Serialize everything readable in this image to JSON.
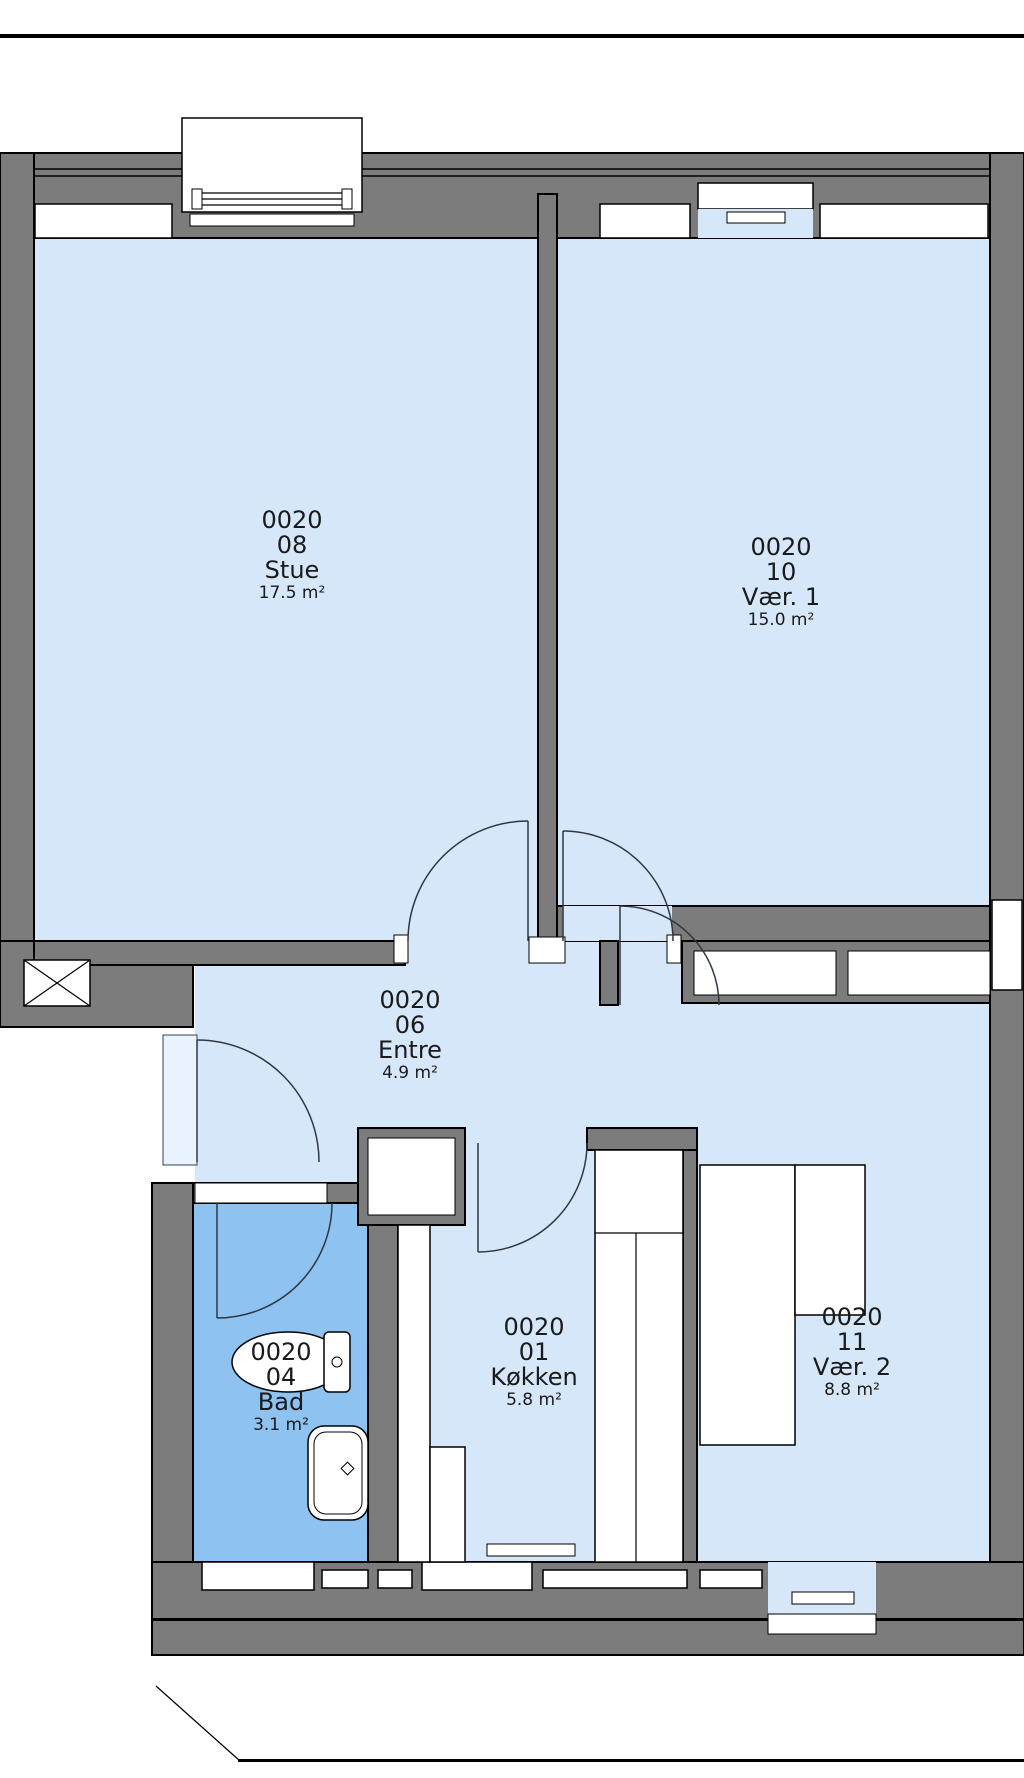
{
  "title": "Apartment floor plan 0020",
  "colors": {
    "wall": "#7c7c7c",
    "room": "#d6e7fa",
    "bathroom": "#8ec2f0",
    "threshold": "#e9f3fd",
    "arc": "#2f3742",
    "label": "#1a1a1a"
  },
  "rooms": [
    {
      "id": "stue",
      "code": "0020",
      "number": "08",
      "name": "Stue",
      "area": "17.5 m²"
    },
    {
      "id": "vaer1",
      "code": "0020",
      "number": "10",
      "name": "Vær. 1",
      "area": "15.0 m²"
    },
    {
      "id": "entre",
      "code": "0020",
      "number": "06",
      "name": "Entre",
      "area": "4.9 m²"
    },
    {
      "id": "bad",
      "code": "0020",
      "number": "04",
      "name": "Bad",
      "area": "3.1 m²"
    },
    {
      "id": "koekken",
      "code": "0020",
      "number": "01",
      "name": "Køkken",
      "area": "5.8 m²"
    },
    {
      "id": "vaer2",
      "code": "0020",
      "number": "11",
      "name": "Vær. 2",
      "area": "8.8 m²"
    }
  ]
}
